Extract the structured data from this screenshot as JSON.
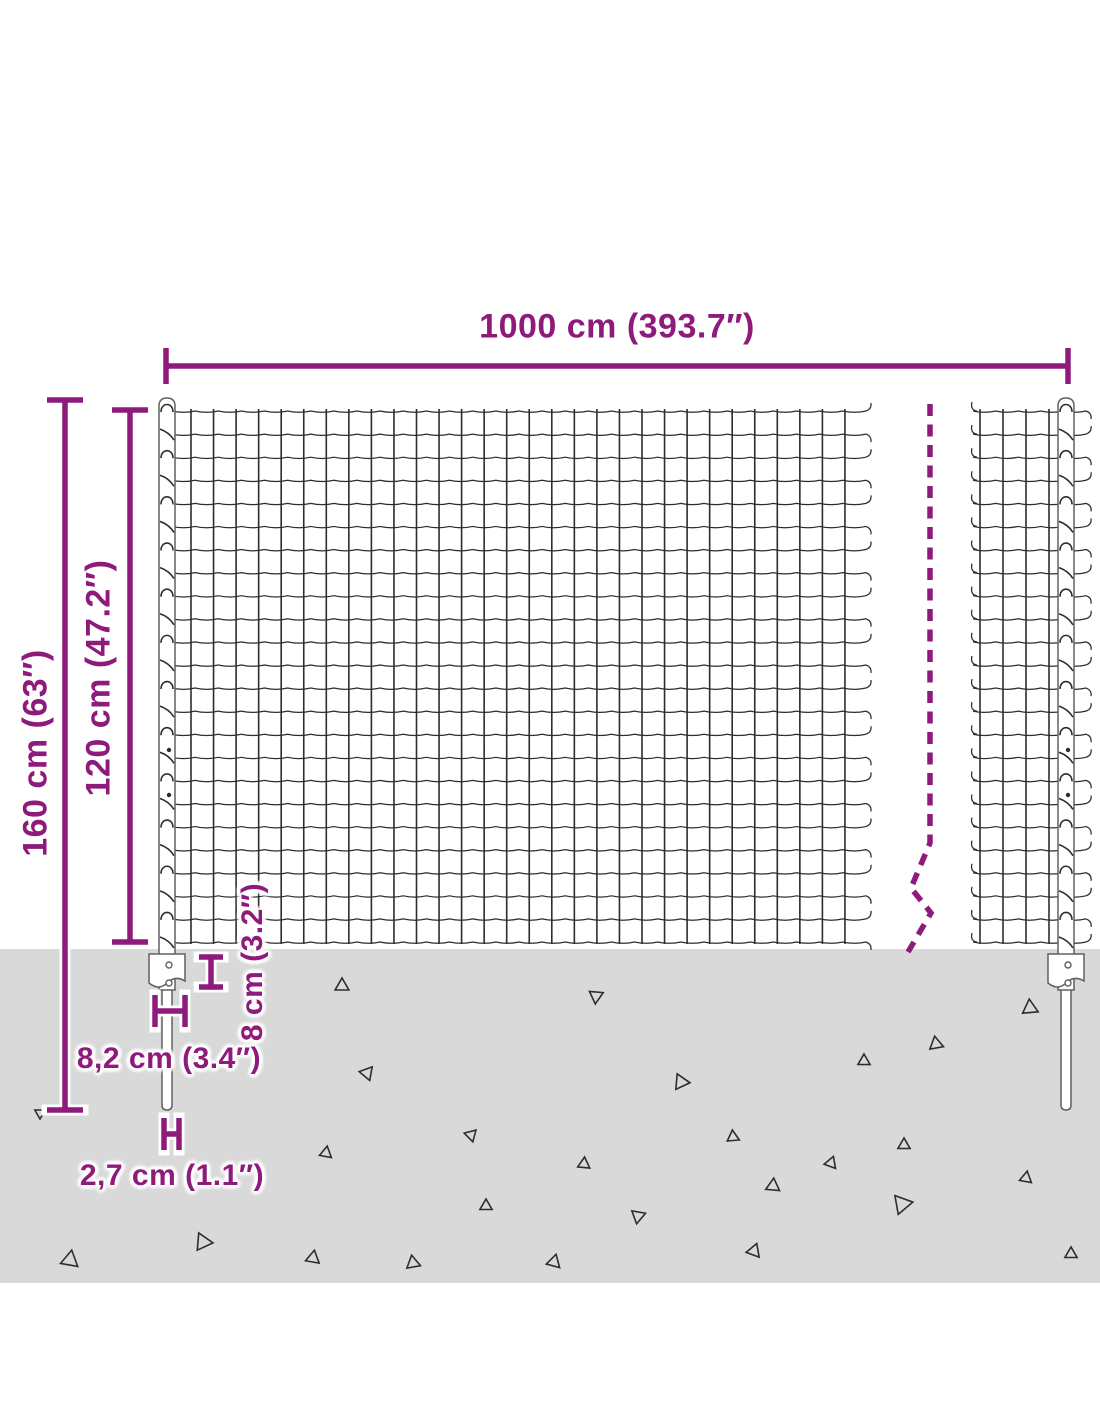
{
  "dimensions": {
    "width_label": "1000 cm (393.7″)",
    "total_height_label": "160 cm (63″)",
    "mesh_height_label": "120 cm (47.2″)",
    "plate_height_label": "8 cm (3.2″)",
    "plate_width_label": "8,2 cm (3.4″)",
    "spike_width_label": "2,7 cm (1.1″)"
  },
  "colors": {
    "dimension": "#8e1a7b",
    "wire": "#2d2d2d",
    "post_stroke": "#606060",
    "post_fill": "#ffffff",
    "ground": "#d9d9d9",
    "background": "#ffffff"
  },
  "diagram": {
    "canvas": {
      "w": 1100,
      "h": 1422
    },
    "ground": {
      "x": 0,
      "y": 949,
      "w": 1100,
      "h": 334
    },
    "mesh": {
      "top": 411,
      "bottom": 942,
      "rows": 24,
      "cell": 23,
      "main": {
        "xStart": 172,
        "xEnd": 866,
        "vFirst": 191,
        "vStep": 22.55,
        "vLast": 852
      },
      "right": {
        "xStart": 973,
        "xEnd": 1086,
        "verticals": [
          980,
          1003,
          1026,
          1049
        ]
      }
    },
    "posts": [
      {
        "cx": 167,
        "top": 398,
        "bodyBottom": 990,
        "halfW": 8,
        "plateHalfW": 18,
        "plateTop": 954,
        "spikeBottom": 1110,
        "spikeHalfW": 5,
        "holes": [
          965,
          983
        ],
        "dots": [
          750,
          795
        ]
      },
      {
        "cx": 1066,
        "top": 398,
        "bodyBottom": 990,
        "halfW": 8,
        "plateHalfW": 18,
        "plateTop": 954,
        "spikeBottom": 1110,
        "spikeHalfW": 5,
        "holes": [
          965,
          983
        ],
        "dots": [
          750,
          795
        ]
      }
    ],
    "break_line": {
      "d": "M 930 404 L 930 843 L 911 888 L 931 913 L 908 952",
      "dash": "12 8.5",
      "width": 5.5
    },
    "dim_segments": [
      [
        166,
        366,
        1068,
        366
      ],
      [
        166,
        348,
        166,
        384
      ],
      [
        1068,
        348,
        1068,
        384
      ],
      [
        65,
        400,
        65,
        1110
      ],
      [
        47,
        400,
        83,
        400
      ],
      [
        47,
        1110,
        83,
        1110
      ],
      [
        130,
        410,
        130,
        942
      ],
      [
        112,
        410,
        148,
        410
      ],
      [
        112,
        942,
        148,
        942
      ],
      [
        211,
        957,
        211,
        987
      ],
      [
        199,
        957,
        223,
        957
      ],
      [
        199,
        987,
        223,
        987
      ],
      [
        155,
        995,
        155,
        1027
      ],
      [
        185,
        995,
        185,
        1027
      ],
      [
        155,
        1011,
        185,
        1011
      ],
      [
        164,
        1118,
        164,
        1150
      ],
      [
        179,
        1118,
        179,
        1150
      ],
      [
        164,
        1134,
        179,
        1134
      ]
    ],
    "triangles": [
      [
        342,
        986,
        8,
        0
      ],
      [
        596,
        996,
        8,
        185
      ],
      [
        1030,
        1008,
        9,
        355
      ],
      [
        936,
        1044,
        8,
        230
      ],
      [
        864,
        1061,
        7,
        240
      ],
      [
        367,
        1073,
        8,
        40
      ],
      [
        681,
        1082,
        9,
        215
      ],
      [
        471,
        1135,
        7,
        45
      ],
      [
        733,
        1137,
        7,
        235
      ],
      [
        904,
        1145,
        7,
        0
      ],
      [
        326,
        1153,
        7,
        250
      ],
      [
        584,
        1164,
        7,
        245
      ],
      [
        831,
        1163,
        7,
        260
      ],
      [
        773,
        1186,
        8,
        245
      ],
      [
        1026,
        1178,
        7,
        250
      ],
      [
        902,
        1204,
        11,
        200
      ],
      [
        638,
        1216,
        8,
        70
      ],
      [
        486,
        1206,
        7,
        0
      ],
      [
        203,
        1242,
        10,
        215
      ],
      [
        70,
        1260,
        10,
        10
      ],
      [
        313,
        1258,
        8,
        250
      ],
      [
        413,
        1263,
        8,
        230
      ],
      [
        754,
        1251,
        8,
        260
      ],
      [
        1071,
        1254,
        7,
        0
      ],
      [
        554,
        1262,
        8,
        15
      ],
      [
        40,
        1113,
        6,
        300
      ]
    ]
  }
}
